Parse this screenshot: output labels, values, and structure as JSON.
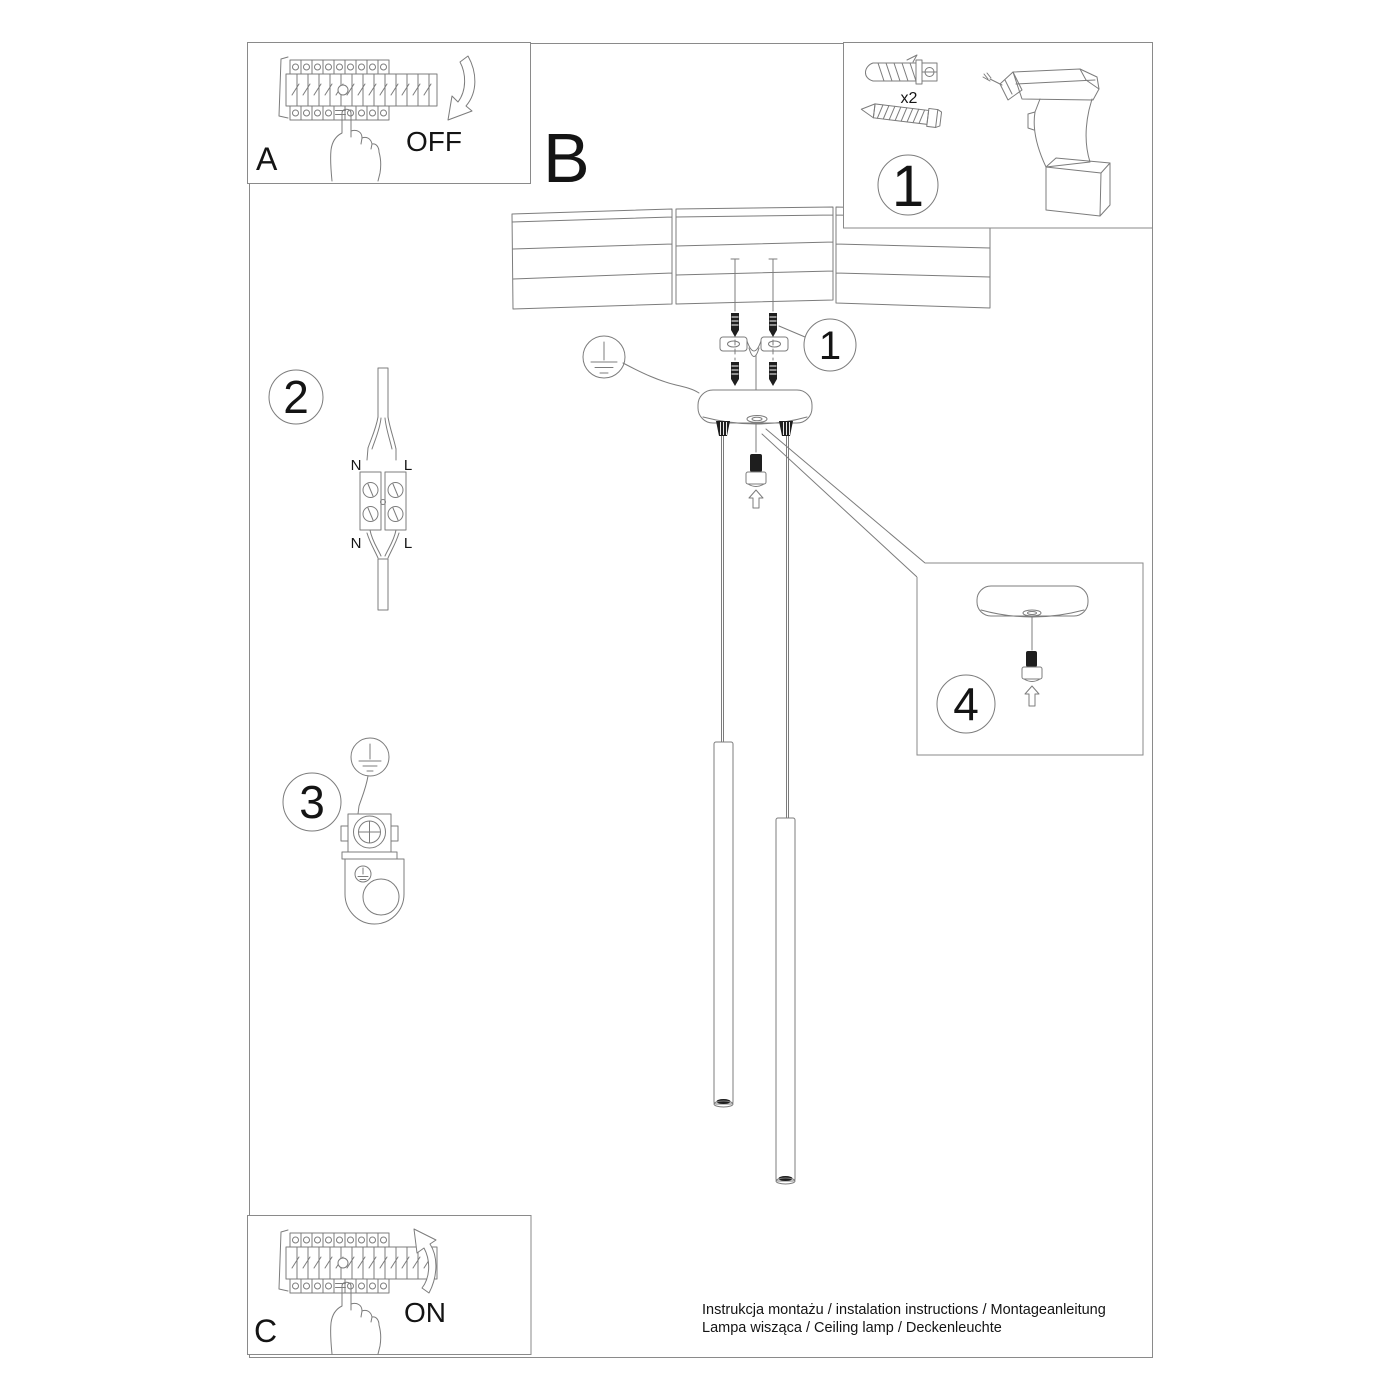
{
  "colors": {
    "line": "#7c7c7c",
    "dark": "#1e1e1e",
    "text": "#141414",
    "bg": "#ffffff"
  },
  "sheet": {
    "panel_a": {
      "label": "A",
      "state": "OFF"
    },
    "panel_b": {
      "label": "B"
    },
    "panel_c": {
      "label": "C",
      "state": "ON"
    },
    "parts": {
      "badge": "1",
      "anchor_qty": "x2"
    },
    "badges": {
      "fixings": "1",
      "wiring": "2",
      "grounding": "3",
      "canopy": "4"
    },
    "wiring": {
      "top_n": "N",
      "top_l": "L",
      "bottom_n": "N",
      "bottom_l": "L"
    },
    "footer": {
      "line1": "Instrukcja montażu / instalation instructions / Montageanleitung",
      "line2": "Lampa wisząca / Ceiling lamp / Deckenleuchte"
    }
  }
}
